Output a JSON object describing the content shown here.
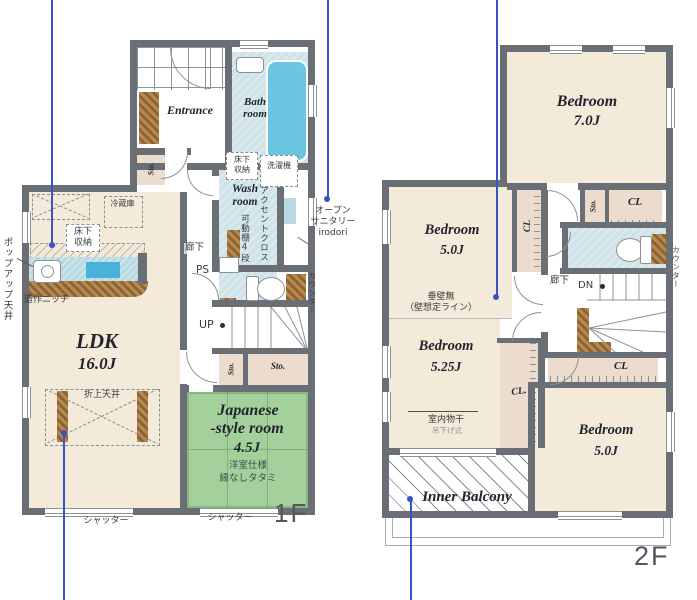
{
  "floor1": {
    "floor_label": "1F",
    "entrance": "Entrance",
    "bath_line1": "Bath",
    "bath_line2": "room",
    "wash_line1": "Wash",
    "wash_line2": "room",
    "ldk_name": "LDK",
    "ldk_size": "16.0J",
    "jp_line1": "Japanese",
    "jp_line2": "-style room",
    "jp_size": "4.5J",
    "jp_note1": "洋室仕様",
    "jp_note2": "縁なしタタミ",
    "sto": "Sto.",
    "underfloor_line1": "床下",
    "underfloor_line2": "収納",
    "laundry": "洗濯機",
    "accent_cloth": "アクセントクロス",
    "shelf": "可動棚4段",
    "hallway": "廊下",
    "ps": "PS",
    "up": "UP",
    "fridge": "冷蔵庫",
    "popup_ceiling": "ポップアップ天井",
    "niche": "造作ニッチ",
    "raised_ceiling": "折上天井",
    "shutter": "シャッター",
    "counter": "カウンター",
    "open_sanitary_line1": "オープン",
    "open_sanitary_line2": "サニタリー",
    "open_sanitary_line3": "irodori"
  },
  "floor2": {
    "floor_label": "2F",
    "bedroom": "Bedroom",
    "bedroom1_size": "7.0J",
    "bedroom2_size": "5.0J",
    "bedroom3_size": "5.25J",
    "bedroom4_size": "5.0J",
    "cl": "CL",
    "cl_dot": "CL.",
    "sto": "Sto.",
    "no_wall_line1": "垂壁無",
    "no_wall_line2": "（壁想定ライン）",
    "drying_line1": "室内物干",
    "drying_line2": "吊下げ式",
    "hallway": "廊下",
    "dn": "DN",
    "counter": "カウンター",
    "inner_balcony": "Inner Balcony"
  },
  "colors": {
    "wall": "#6a6e75",
    "floor": "#f3ead9",
    "wet_room": "#cfe3e9",
    "tub": "#6cc6e2",
    "tatami": "#a3d09b",
    "closet": "#ecdccd",
    "wood": "#a87a44",
    "annotation_blue": "#3952c4"
  }
}
